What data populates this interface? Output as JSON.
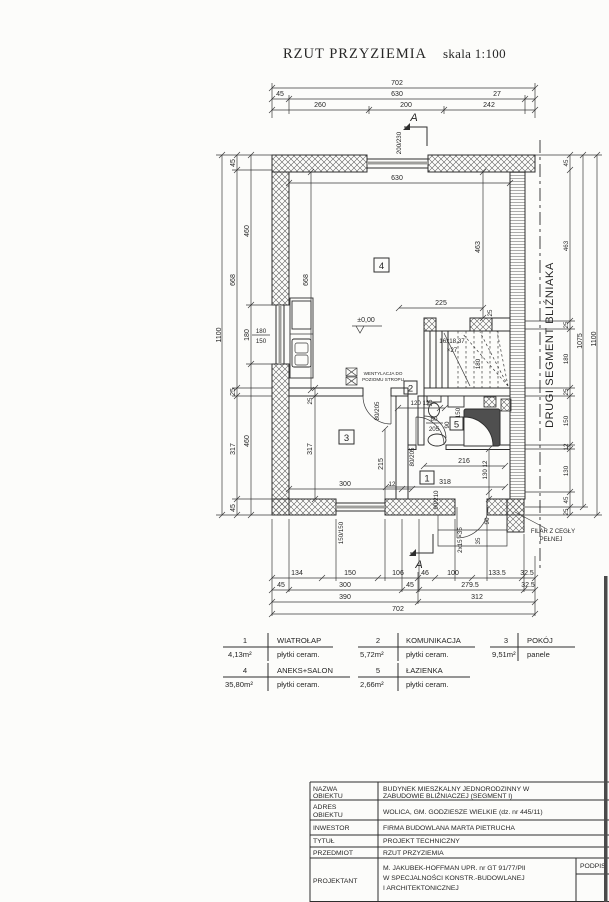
{
  "title": {
    "main": "RZUT PRZYZIEMIA",
    "scale": "skala 1:100"
  },
  "party_wall_label": "DRUGI SEGMENT BLIŹNIAKA",
  "dims": {
    "top_total": "702",
    "top_chain2": [
      "45",
      "630",
      "27"
    ],
    "top_chain3": [
      "260",
      "200",
      "242"
    ],
    "left_total": "1100",
    "left_mid": [
      "45",
      "668",
      "25",
      "317",
      "45"
    ],
    "left_inner": [
      "460",
      "180",
      "460"
    ],
    "right_chain": [
      "45",
      "463",
      "25",
      "180",
      "25",
      "150",
      "12",
      "130",
      "45",
      "25"
    ],
    "right_subtotal": "1075",
    "right_total": "1100",
    "bottom_chain1": [
      "134",
      "150",
      "106",
      "46",
      "100",
      "133.5",
      "32.5"
    ],
    "bottom_chain2": [
      "45",
      "300",
      "45",
      "279.5",
      "32.5"
    ],
    "bottom_chain3": [
      "390",
      "312"
    ],
    "bottom_total": "702"
  },
  "plan": {
    "section_label": "A",
    "level_label": "±0,00",
    "stairs_label": "16x18,37",
    "stairs_label2": "×27",
    "stairs_width": "180",
    "vent_line1": "WENTYLACJA DO",
    "vent_line2": "POZIOMU STROPU",
    "pillar_line1": "FILAR Z CEGŁY",
    "pillar_line2": "PEŁNEJ",
    "rooms": {
      "r1": "1",
      "r2": "2",
      "r3": "3",
      "r4": "4",
      "r5": "5"
    },
    "win_top": "200/230",
    "win_left_w": "180",
    "win_left_h": "150",
    "win_bottom": "150/150",
    "door_entry": "90/210",
    "door_a": "80/205",
    "door_b_w": "80",
    "door_b_h": "205",
    "door_c": "80/205",
    "d630": "630",
    "d668": "668",
    "d463": "463",
    "d225": "225",
    "d25a": "25",
    "d25b": "25",
    "d317": "317",
    "d300": "300",
    "d215": "215",
    "d12": "12",
    "d120": "120 12",
    "d216": "216",
    "d130": "130 12",
    "d318": "318",
    "d90": "90",
    "d35": "35",
    "d35b": "35",
    "d90b": "90",
    "d150b": "150",
    "steps": "2x15 ×35"
  },
  "legend": [
    {
      "num": "1",
      "name": "WIATROŁAP",
      "area": "4,13m²",
      "finish": "płytki ceram."
    },
    {
      "num": "2",
      "name": "KOMUNIKACJA",
      "area": "5,72m²",
      "finish": "płytki ceram."
    },
    {
      "num": "3",
      "name": "POKÓJ",
      "area": "9,51m²",
      "finish": "panele"
    },
    {
      "num": "4",
      "name": "ANEKS+SALON",
      "area": "35,80m²",
      "finish": "płytki ceram."
    },
    {
      "num": "5",
      "name": "ŁAZIENKA",
      "area": "2,66m²",
      "finish": "płytki ceram."
    }
  ],
  "titleblock": {
    "rows": [
      {
        "label1": "NAZWA",
        "label2": "OBIEKTU",
        "value1": "BUDYNEK MIESZKALNY JEDNORODZINNY  W",
        "value2": "ZABUDOWIE BLIŹNIACZEJ (SEGMENT I)"
      },
      {
        "label1": "ADRES",
        "label2": "OBIEKTU",
        "value1": "WOLICA, GM. GODZIESZE WIELKIE (dz. nr 445/11)"
      },
      {
        "label": "INWESTOR",
        "value": "FIRMA BUDOWLANA MARTA PIETRUCHA"
      },
      {
        "label": "TYTUŁ",
        "value": "PROJEKT TECHNICZNY"
      },
      {
        "label": "PRZEDMIOT",
        "value": "RZUT PRZYZIEMIA"
      },
      {
        "label": "PROJEKTANT",
        "value1": "M. JAKUBEK-HOFFMAN UPR. nr GT 91/77/PII",
        "value2": "W SPECJALNOŚCI KONSTR.-BUDOWLANEJ",
        "value3": "I ARCHITEKTONICZNEJ",
        "signature": "PODPIS"
      }
    ]
  },
  "colors": {
    "ink": "#2e2e2e",
    "paper": "#fcfcfa",
    "glass": "#9f9f9c"
  }
}
